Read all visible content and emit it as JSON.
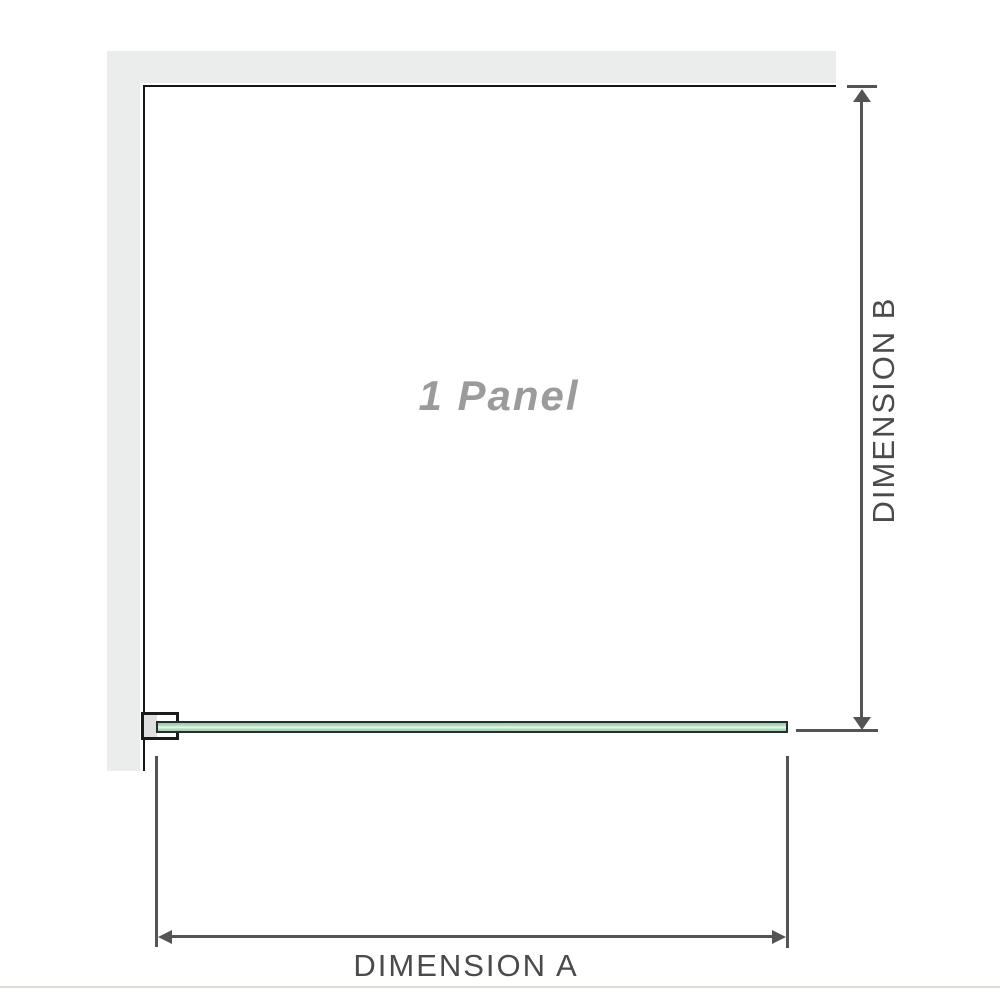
{
  "diagram": {
    "title": "Shower screen panel configuration diagram",
    "panel_label": "1 Panel",
    "dimension_a_label": "DIMENSION A",
    "dimension_b_label": "DIMENSION B"
  },
  "colors": {
    "wall_fill": "#ebecec",
    "panel_outline": "#161616",
    "glass_green": "#aedec0",
    "glass_highlight": "#e9f7ee",
    "glass_outline": "#2c2c2c",
    "bracket_outline": "#1b1b1b",
    "bracket_pad": "#e0e0e0",
    "dimension_line": "#545454",
    "dimension_text": "#4b4b4b",
    "panel_text": "#9b9b9b",
    "page_rule": "#dfdcd4"
  }
}
